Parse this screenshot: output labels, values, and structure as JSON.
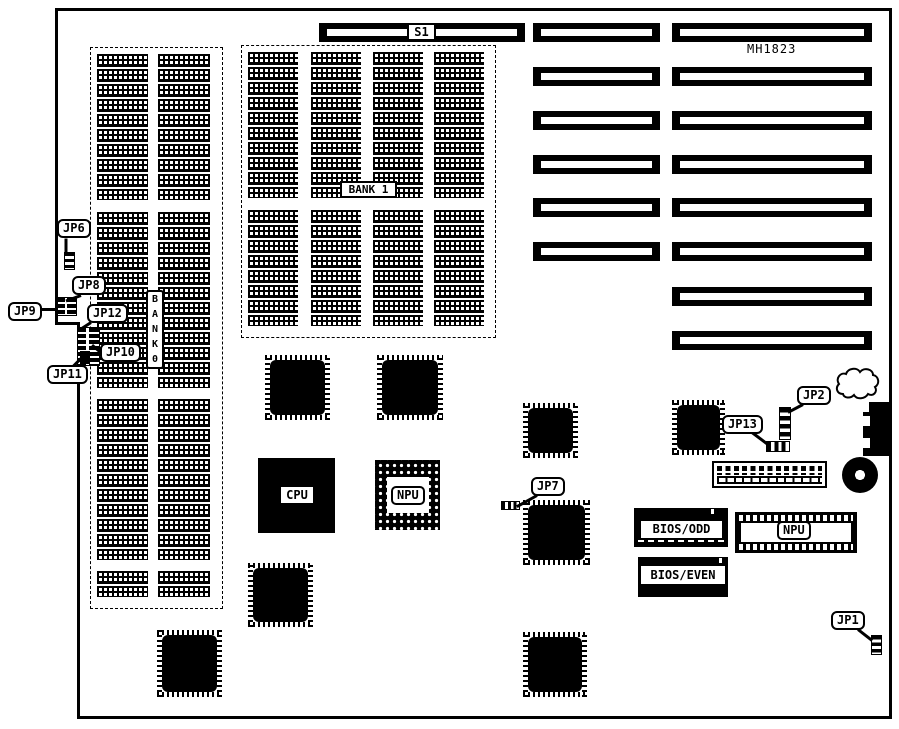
{
  "board": {
    "model": "MH1823"
  },
  "labels": {
    "s1": "S1",
    "bank1": "BANK 1",
    "bank0": [
      "B",
      "A",
      "N",
      "K",
      "0"
    ],
    "cpu": "CPU",
    "npu": "NPU",
    "npu_socket": "NPU",
    "bios_odd": "BIOS/ODD",
    "bios_even": "BIOS/EVEN",
    "jp1": "JP1",
    "jp2": "JP2",
    "jp6": "JP6",
    "jp7": "JP7",
    "jp8": "JP8",
    "jp9": "JP9",
    "jp10": "JP10",
    "jp11": "JP11",
    "jp12": "JP12",
    "jp13": "JP13"
  }
}
